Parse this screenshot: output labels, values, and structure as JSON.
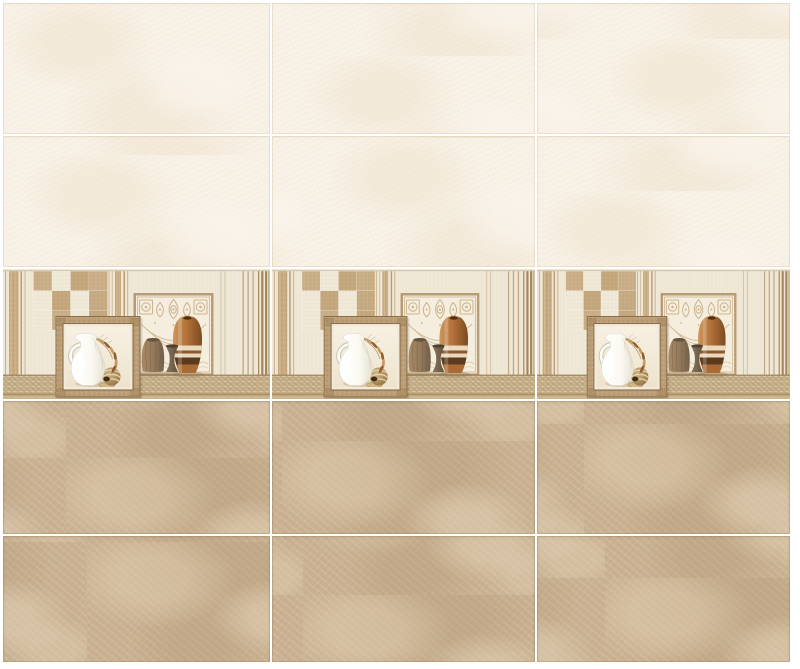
{
  "canvas": {
    "width": 800,
    "height": 669,
    "background": "#ffffff",
    "description": "Ceramic wall tile layout preview: two rows of plain ivory tiles, one decorative still-life highlighter row, two rows of beige marble-effect tiles separated by white grout"
  },
  "wall": {
    "left": 3,
    "top": 3,
    "width": 787,
    "height": 659,
    "grout_size": 2,
    "grout_color": "#ffffff",
    "column_widths": [
      267,
      263,
      253
    ],
    "row_heights": [
      131,
      131,
      130,
      133,
      126
    ],
    "row_types": [
      "cream",
      "cream",
      "decor",
      "beige",
      "beige"
    ]
  },
  "tile_types": {
    "cream": {
      "name": "plain ivory wall tile",
      "color": "#f7f0e4"
    },
    "decor": {
      "name": "decorative still-life highlighter tile"
    },
    "beige": {
      "name": "beige marble-effect wall tile",
      "color": "#c9b192"
    }
  },
  "decor_tile": {
    "motifs": [
      "vertical-stripe-band-left",
      "checkerboard-panel",
      "framed-pitcher-picture",
      "embossed-ornament-panel",
      "ribbed-barrel-vase",
      "spool-vase",
      "copper-striped-gourd-vase",
      "woven-ledge",
      "vertical-stripe-band-right"
    ],
    "checker_pattern": [
      [
        1,
        0,
        1,
        1
      ],
      [
        0,
        1,
        0,
        1
      ],
      [
        0,
        1,
        0,
        1
      ]
    ],
    "checker_cell": {
      "width": 18.5,
      "height": 19.6,
      "origin_x": 30.5,
      "origin_y": 2.2
    }
  },
  "colors": {
    "page_bg": "#ffffff",
    "grout": "#ffffff",
    "cream_tile": "#f7f0e4",
    "beige_tile": "#c9b192",
    "deco_bg": "#f0e8d7",
    "stripe_line": "#b99c74",
    "stripe_band": "#c4a77e",
    "stripe_band_light": "#dcc5a0",
    "stripe_dark": "#a4865c",
    "checker_tan": "#c3a67c",
    "checker_cream": "#f0e8d6",
    "panel_frame": "#b79b74",
    "panel_bg": "#f5eede",
    "ornament": "#c9b28c",
    "ledge": "#ccb68f",
    "ledge_dark": "#ab9064",
    "ledge_foot": "#cdb58c",
    "frame_band": "#bb9e76",
    "frame_line": "#8a6e4d",
    "frame_corner": "#a8895f",
    "mat": "#f2ead9",
    "jug_white": "#fefdf9",
    "jug_shade": "#dcd6c5",
    "wheat": "#b5854f",
    "wheat_dark": "#8d5e31",
    "wheat_light": "#c69a62",
    "ball_light": "#cdab77",
    "ball_dark": "#8d6a3c",
    "ball_hole": "#3f2c17",
    "ball_stripe": "#ead9b5",
    "barrel_top": "#67543c",
    "spool_top": "#4f4130",
    "copper": "#b06f38",
    "copper_dark": "#7c4a20",
    "band_cream": "#ead9bc",
    "band_brown": "#8a5a30",
    "band_darkbrown": "#5c3a1e",
    "shadow": "#8f7550"
  }
}
